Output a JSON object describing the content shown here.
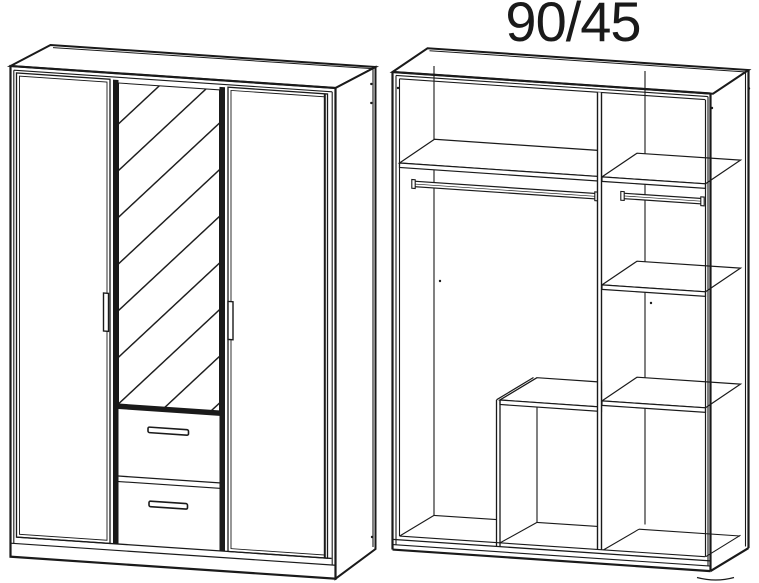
{
  "title": "90/45",
  "colors": {
    "background": "#ffffff",
    "line": "#1a1a1a"
  },
  "diagram": {
    "left_view": "wardrobe-exterior-three-doors-mirror-two-drawers",
    "right_view": "wardrobe-interior-shelves-and-hanging-rails"
  }
}
